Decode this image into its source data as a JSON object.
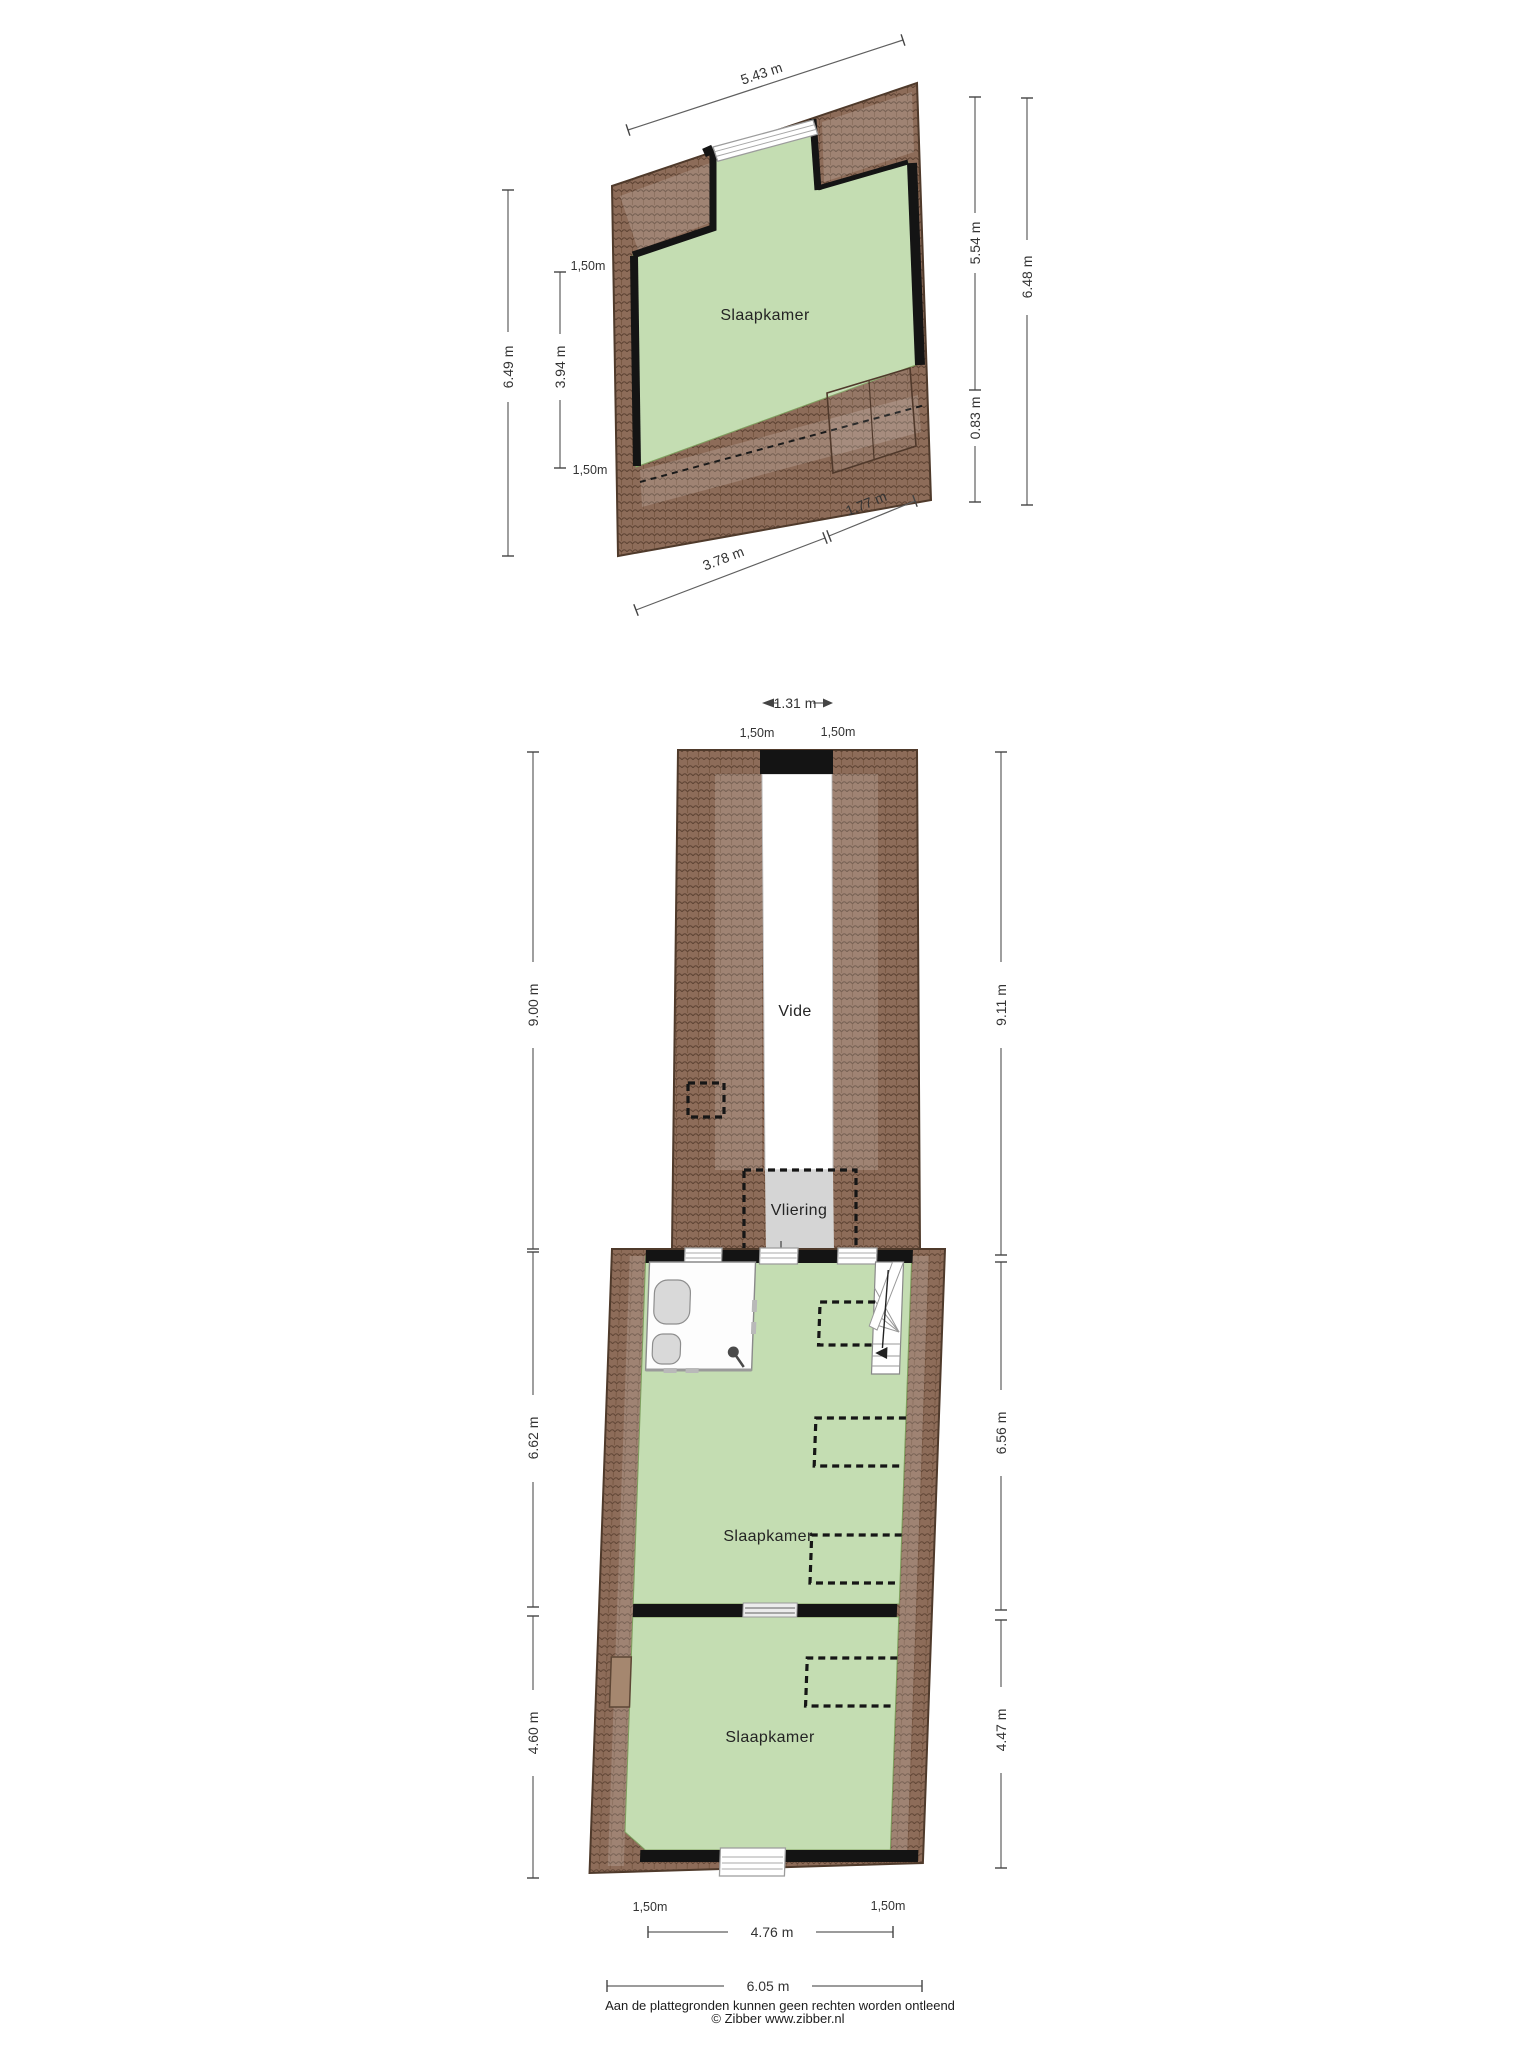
{
  "floor_top": {
    "room": "Slaapkamer",
    "dim_top": "5.43 m",
    "dim_left_outer": "6.49 m",
    "dim_left_knee_top": "1,50m",
    "dim_left_inner": "3.94 m",
    "dim_left_knee_bottom": "1,50m",
    "dim_right_inner": "5.54 m",
    "dim_right_lower": "0.83 m",
    "dim_right_outer": "6.48 m",
    "dim_bottom_left": "3.78 m",
    "dim_bottom_right": "1.77 m"
  },
  "floor_bottom": {
    "void_label": "Vide",
    "loft_label": "Vliering",
    "bedroom_mid": "Slaapkamer",
    "bedroom_bottom": "Slaapkamer",
    "dim_void_width": "1.31 m",
    "dim_knee_top_left": "1,50m",
    "dim_knee_top_right": "1,50m",
    "dim_left_upper": "9.00 m",
    "dim_right_upper": "9.11 m",
    "dim_left_mid": "6.62 m",
    "dim_right_mid": "6.56 m",
    "dim_left_lower": "4.60 m",
    "dim_right_lower": "4.47 m",
    "dim_knee_bottom_left": "1,50m",
    "dim_knee_bottom_right": "1,50m",
    "dim_bottom_inner": "4.76 m",
    "dim_bottom_outer": "6.05 m"
  },
  "footer": {
    "line1": "Aan de plattegronden kunnen geen rechten worden ontleend",
    "line2": "© Zibber www.zibber.nl"
  },
  "colors": {
    "room_green": "#c4ddb2",
    "roof_brown": "#8d6c59",
    "loft_gray": "#d5d5d5",
    "wall_black": "#141414"
  }
}
